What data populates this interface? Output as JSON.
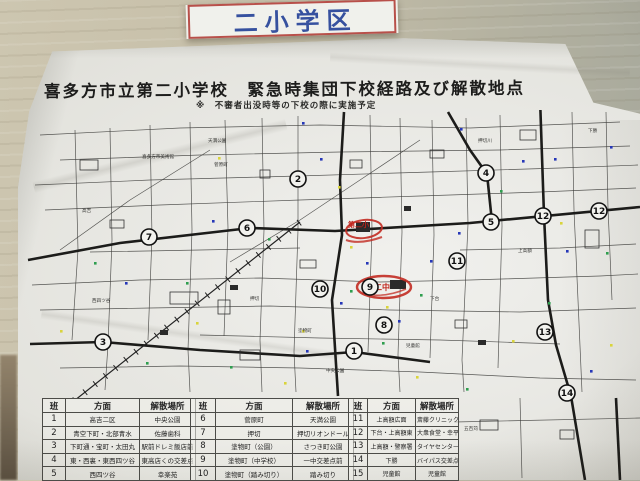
{
  "sign": {
    "label": "二小学区"
  },
  "poster": {
    "title": "喜多方市立第二小学校　緊急時集団下校経路及び解散地点",
    "subtitle": "※　不審者出没時等の下校の際に実施予定"
  },
  "map": {
    "school_mark": "第二小",
    "junior_high_mark": "二中",
    "circles": [
      {
        "n": "1",
        "x": 354,
        "y": 351
      },
      {
        "n": "2",
        "x": 298,
        "y": 179
      },
      {
        "n": "3",
        "x": 103,
        "y": 342
      },
      {
        "n": "4",
        "x": 486,
        "y": 173
      },
      {
        "n": "5",
        "x": 491,
        "y": 222
      },
      {
        "n": "6",
        "x": 247,
        "y": 228
      },
      {
        "n": "7",
        "x": 149,
        "y": 237
      },
      {
        "n": "8",
        "x": 384,
        "y": 325
      },
      {
        "n": "9",
        "x": 370,
        "y": 287
      },
      {
        "n": "10",
        "x": 320,
        "y": 289
      },
      {
        "n": "11",
        "x": 457,
        "y": 261
      },
      {
        "n": "12",
        "x": 543,
        "y": 216
      },
      {
        "n": "12",
        "x": 599,
        "y": 211
      },
      {
        "n": "13",
        "x": 545,
        "y": 332
      },
      {
        "n": "14",
        "x": 567,
        "y": 393
      }
    ],
    "area_labels": [
      {
        "t": "高吉",
        "x": 82,
        "y": 212
      },
      {
        "t": "西四ツ谷",
        "x": 92,
        "y": 302
      },
      {
        "t": "菅原町",
        "x": 214,
        "y": 166
      },
      {
        "t": "押切",
        "x": 250,
        "y": 300
      },
      {
        "t": "塗物町",
        "x": 298,
        "y": 332
      },
      {
        "t": "喜多方市美術館",
        "x": 142,
        "y": 158
      },
      {
        "t": "下台",
        "x": 430,
        "y": 300
      },
      {
        "t": "上高額",
        "x": 518,
        "y": 252
      },
      {
        "t": "下勝",
        "x": 588,
        "y": 132
      },
      {
        "t": "五百苅",
        "x": 464,
        "y": 430
      },
      {
        "t": "天満公園",
        "x": 208,
        "y": 142
      },
      {
        "t": "中央公園",
        "x": 326,
        "y": 372
      },
      {
        "t": "児童館",
        "x": 406,
        "y": 347
      },
      {
        "t": "押切川",
        "x": 478,
        "y": 142
      }
    ],
    "dots": [
      [
        320,
        158,
        "b"
      ],
      [
        212,
        220,
        "b"
      ],
      [
        125,
        282,
        "b"
      ],
      [
        460,
        128,
        "b"
      ],
      [
        554,
        158,
        "b"
      ],
      [
        522,
        160,
        "b"
      ],
      [
        566,
        250,
        "b"
      ],
      [
        458,
        232,
        "b"
      ],
      [
        366,
        262,
        "b"
      ],
      [
        306,
        350,
        "b"
      ],
      [
        398,
        320,
        "b"
      ],
      [
        340,
        302,
        "b"
      ],
      [
        430,
        260,
        "b"
      ],
      [
        610,
        146,
        "b"
      ],
      [
        590,
        370,
        "b"
      ],
      [
        302,
        122,
        "b"
      ],
      [
        268,
        238,
        "g"
      ],
      [
        186,
        282,
        "g"
      ],
      [
        146,
        362,
        "g"
      ],
      [
        500,
        190,
        "g"
      ],
      [
        548,
        302,
        "g"
      ],
      [
        420,
        294,
        "g"
      ],
      [
        382,
        342,
        "g"
      ],
      [
        230,
        366,
        "g"
      ],
      [
        94,
        262,
        "g"
      ],
      [
        606,
        252,
        "g"
      ],
      [
        350,
        290,
        "g"
      ],
      [
        466,
        388,
        "g"
      ],
      [
        218,
        157,
        "y"
      ],
      [
        196,
        322,
        "y"
      ],
      [
        350,
        246,
        "y"
      ],
      [
        386,
        306,
        "y"
      ],
      [
        302,
        330,
        "y"
      ],
      [
        560,
        222,
        "y"
      ],
      [
        610,
        344,
        "y"
      ],
      [
        284,
        382,
        "y"
      ],
      [
        60,
        330,
        "y"
      ],
      [
        512,
        340,
        "y"
      ],
      [
        416,
        376,
        "y"
      ],
      [
        338,
        186,
        "y"
      ]
    ]
  },
  "tables": [
    {
      "headers": [
        "班",
        "方面",
        "解散場所"
      ],
      "rows": [
        [
          "1",
          "高吉二区",
          "中央公園"
        ],
        [
          "2",
          "青空下町・北部青水",
          "佐藤歯科"
        ],
        [
          "3",
          "下町通・宝町・太田丸",
          "駅前ドレミ飯店前"
        ],
        [
          "4",
          "東・西裏・東西四ツ谷",
          "東高店くの交差点"
        ],
        [
          "5",
          "西四ツ谷",
          "幸楽苑"
        ]
      ]
    },
    {
      "headers": [
        "班",
        "方面",
        "解散場所"
      ],
      "rows": [
        [
          "6",
          "菅原町",
          "天満公園"
        ],
        [
          "7",
          "押切",
          "押切リオンドール"
        ],
        [
          "8",
          "塗物町（公園）",
          "さつき町公園"
        ],
        [
          "9",
          "塗物町（中学校）",
          "一中交差点前"
        ],
        [
          "10",
          "塗物町（踏み切り）",
          "踏み切り"
        ]
      ]
    },
    {
      "headers": [
        "班",
        "方面",
        "解散場所"
      ],
      "rows": [
        [
          "11",
          "上高額広面",
          "斎藤クリニック"
        ],
        [
          "12",
          "下台・上高額東",
          "大衆食堂・幸平食堂"
        ],
        [
          "13",
          "上高額・警察署",
          "タイヤセンター"
        ],
        [
          "14",
          "下勝",
          "バイパス交差点"
        ],
        [
          "15",
          "児童館",
          "児童館"
        ]
      ]
    }
  ]
}
